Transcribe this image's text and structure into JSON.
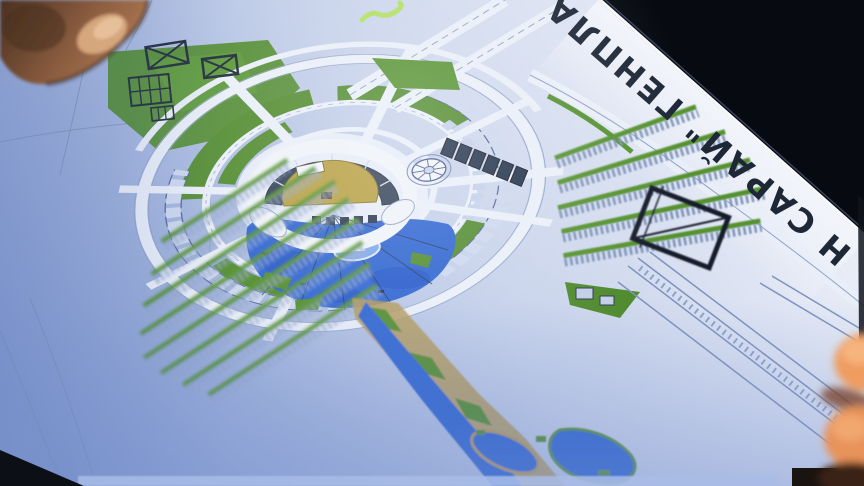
{
  "photo": {
    "plan_title_fragment": "Н САРАЙ\" ГЕНПЛА"
  },
  "colors": {
    "background": "#070a10",
    "paper_highlight": "#eef1f9",
    "paper_blue_cast": "#7e97cf",
    "drawing_line": "#44568a",
    "lawn": "#4f8a2c",
    "water": "#2b62d0",
    "amphitheater_yellow": "#b59d3d",
    "annotation_ink": "#141e2b",
    "marker_highlight": "#aede52",
    "skin_shadow": "#6e4a33",
    "skin_bright": "#ef9c60"
  }
}
